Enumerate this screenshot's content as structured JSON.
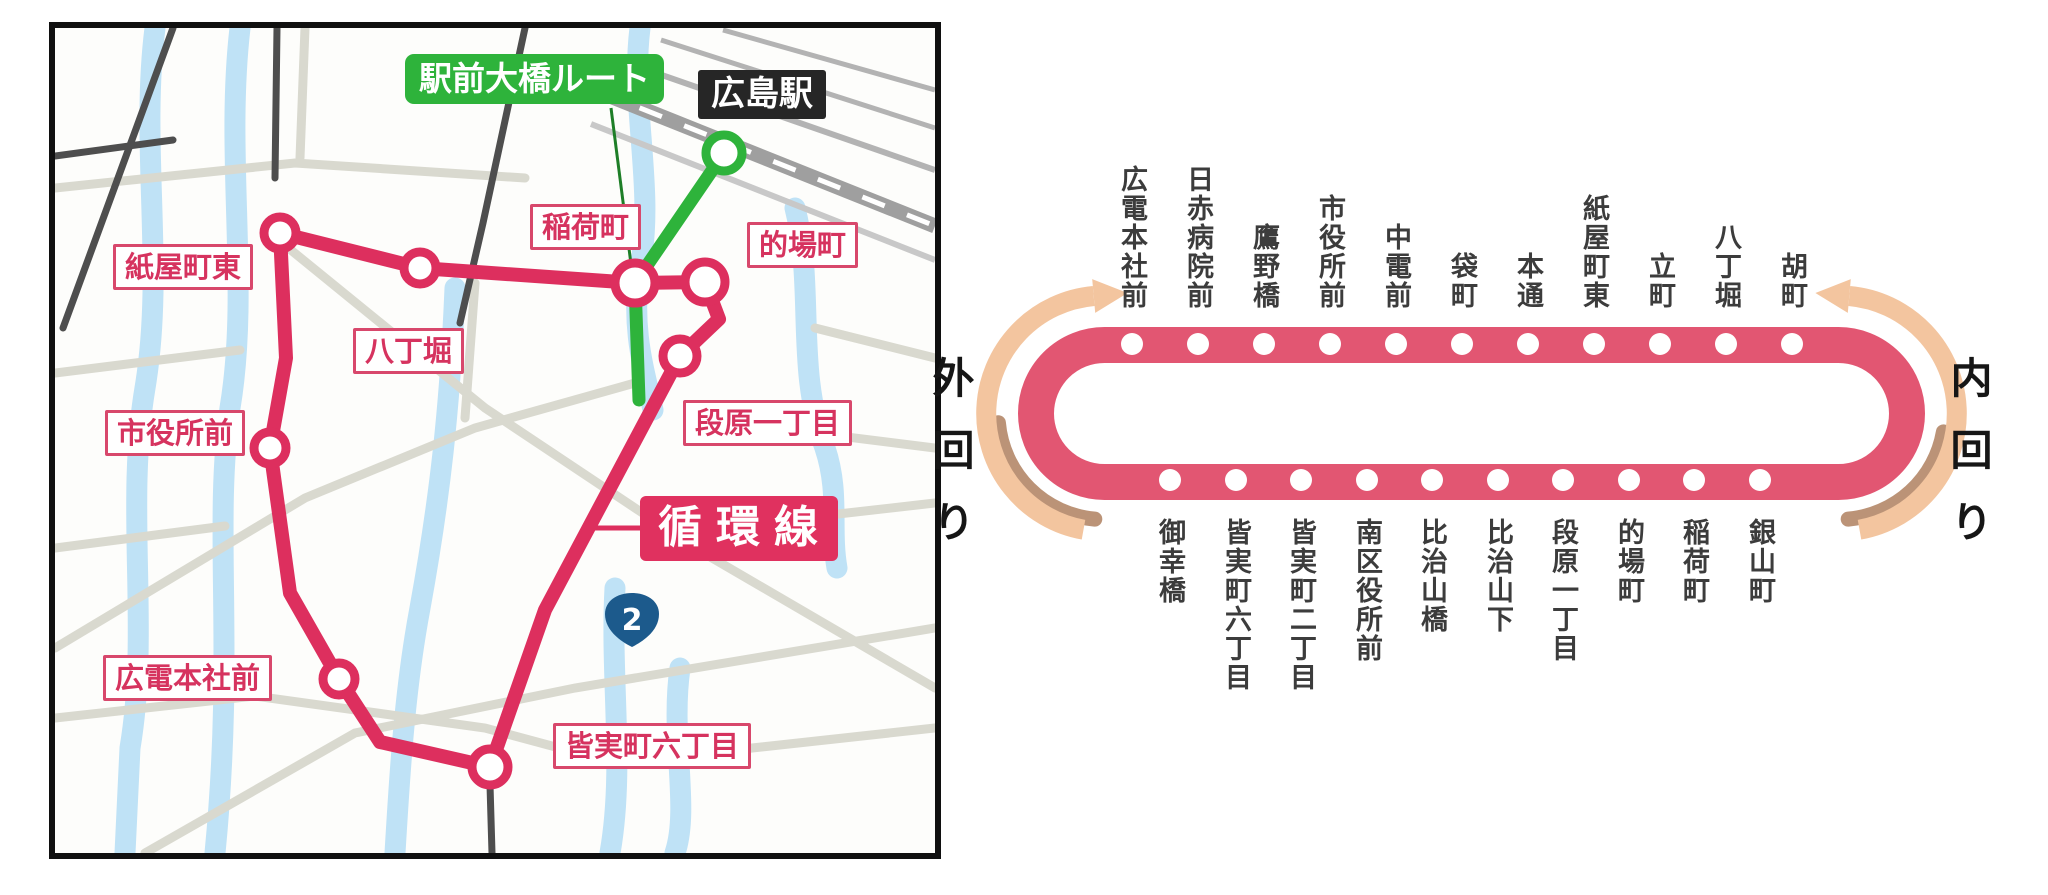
{
  "map": {
    "labels": {
      "green_route": "駅前大橋ルート",
      "hiroshima_station": "広島駅",
      "inarimachi": "稲荷町",
      "matobacho": "的場町",
      "kamiyacho_higashi": "紙屋町東",
      "hatchobori": "八丁堀",
      "danbara_itchome": "段原一丁目",
      "shiyakusho_mae": "市役所前",
      "loop_line": "循環線",
      "hiroden_honsha_mae": "広電本社前",
      "minamimachi_rokuchome": "皆実町六丁目",
      "route_badge": "2"
    },
    "colors": {
      "loop_route_pink": "#dd2f5e",
      "green_route": "#2eb33b",
      "river_blue": "#bfe2f6",
      "road_light": "#d9d9cf",
      "road_dark": "#4e4e4e",
      "railway_gray": "#9f9f9f",
      "badge_blue": "#1c5a8c",
      "label_pink": "#d6335f",
      "station_label_black_bg": "#262626"
    }
  },
  "loop_diagram": {
    "direction_left": "外回り",
    "direction_right": "内回り",
    "top_stations": [
      "広電本社前",
      "日赤病院前",
      "鷹野橋",
      "市役所前",
      "中電前",
      "袋町",
      "本通",
      "紙屋町東",
      "立町",
      "八丁堀",
      "胡町"
    ],
    "bottom_stations": [
      "御幸橋",
      "皆実町六丁目",
      "皆実町二丁目",
      "南区役所前",
      "比治山橋",
      "比治山下",
      "段原一丁目",
      "的場町",
      "稲荷町",
      "銀山町"
    ],
    "colors": {
      "ring_pink": "#e25672",
      "dot_white": "#ffffff",
      "arrow_peach": "#f3c59f",
      "arrow_shadow": "#bb9377",
      "text": "#3c3c3c"
    }
  }
}
